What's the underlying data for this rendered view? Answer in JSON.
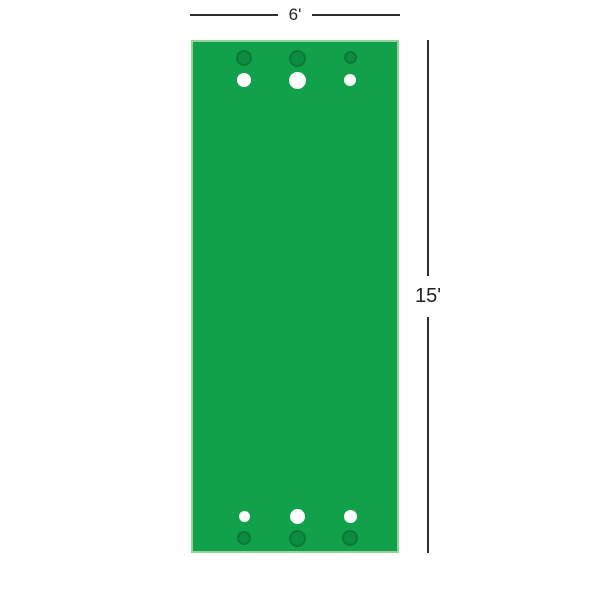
{
  "diagram": {
    "name": "putting-green-dimension-diagram",
    "width_label": "6'",
    "height_label": "15'",
    "colors": {
      "mat_fill": "#12A14B",
      "mat_border": "#93D39B",
      "cup_fill": "#0D8C40",
      "cup_border": "#0B7838",
      "ball_fill": "#FFFFFF",
      "dimension_line": "#2E2E2E",
      "label_text": "#222222"
    },
    "mat": {
      "left": 191,
      "top": 40,
      "width": 208,
      "height": 513
    },
    "holes": [
      {
        "row": "top-cups",
        "type": "cup",
        "x": 51,
        "y": 16,
        "d": 16
      },
      {
        "row": "top-cups",
        "type": "cup",
        "x": 104,
        "y": 16,
        "d": 17
      },
      {
        "row": "top-cups",
        "type": "cup",
        "x": 157,
        "y": 15,
        "d": 13
      },
      {
        "row": "top-balls",
        "type": "ball",
        "x": 51,
        "y": 38,
        "d": 14
      },
      {
        "row": "top-balls",
        "type": "ball",
        "x": 104,
        "y": 38,
        "d": 17
      },
      {
        "row": "top-balls",
        "type": "ball",
        "x": 157,
        "y": 38,
        "d": 12
      },
      {
        "row": "bottom-balls",
        "type": "ball",
        "x": 51,
        "y": 474,
        "d": 11
      },
      {
        "row": "bottom-balls",
        "type": "ball",
        "x": 104,
        "y": 474,
        "d": 15
      },
      {
        "row": "bottom-balls",
        "type": "ball",
        "x": 157,
        "y": 474,
        "d": 13
      },
      {
        "row": "bottom-cups",
        "type": "cup",
        "x": 51,
        "y": 496,
        "d": 14
      },
      {
        "row": "bottom-cups",
        "type": "cup",
        "x": 104,
        "y": 496,
        "d": 17
      },
      {
        "row": "bottom-cups",
        "type": "cup",
        "x": 157,
        "y": 496,
        "d": 16
      }
    ]
  }
}
